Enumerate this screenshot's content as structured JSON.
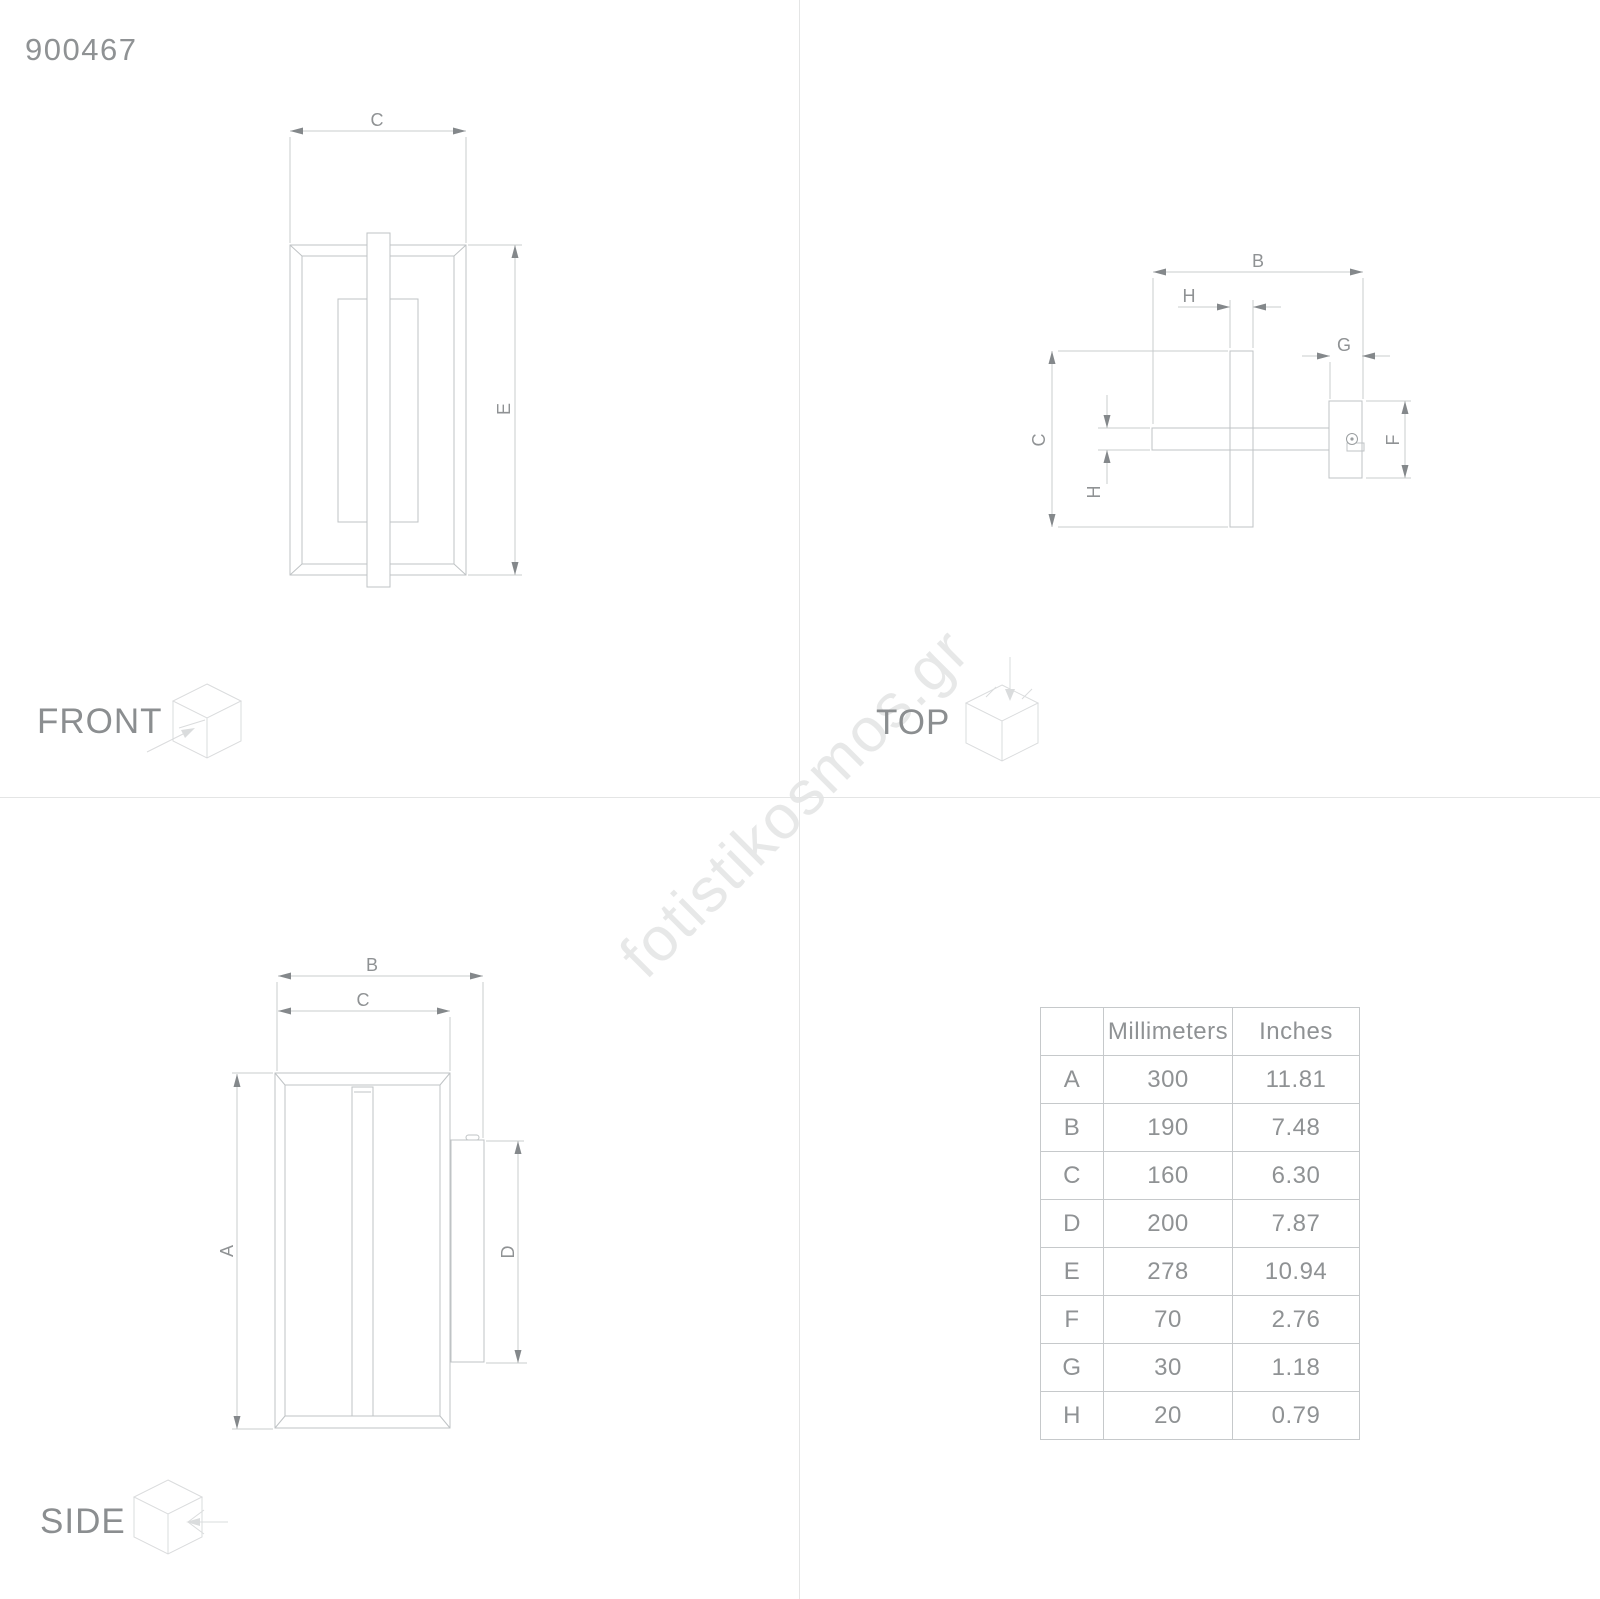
{
  "article_number": "900467",
  "watermark": {
    "text": "fotistikosmos.gr",
    "color": "#e7e8e8"
  },
  "front": {
    "label": "FRONT",
    "dim_c": "C",
    "dim_e": "E"
  },
  "top": {
    "label": "TOP",
    "dim_b": "B",
    "dim_h_top": "H",
    "dim_g": "G",
    "dim_c": "C",
    "dim_h_side": "H",
    "dim_f": "F"
  },
  "side": {
    "label": "SIDE",
    "dim_b": "B",
    "dim_c": "C",
    "dim_a": "A",
    "dim_d": "D"
  },
  "table": {
    "headers": [
      "",
      "Millimeters",
      "Inches"
    ],
    "rows": [
      {
        "letter": "A",
        "mm": "300",
        "inches": "11.81"
      },
      {
        "letter": "B",
        "mm": "190",
        "inches": "7.48"
      },
      {
        "letter": "C",
        "mm": "160",
        "inches": "6.30"
      },
      {
        "letter": "D",
        "mm": "200",
        "inches": "7.87"
      },
      {
        "letter": "E",
        "mm": "278",
        "inches": "10.94"
      },
      {
        "letter": "F",
        "mm": "70",
        "inches": "2.76"
      },
      {
        "letter": "G",
        "mm": "30",
        "inches": "1.18"
      },
      {
        "letter": "H",
        "mm": "20",
        "inches": "0.79"
      }
    ]
  },
  "colors": {
    "object_line": "#bfc3c5",
    "dimension_line": "#c9cccd",
    "arrow": "#84888b",
    "text_gray": "#8f9294",
    "watermark_gray": "#e7e8e8",
    "divider_gray": "#e4e5e5"
  }
}
